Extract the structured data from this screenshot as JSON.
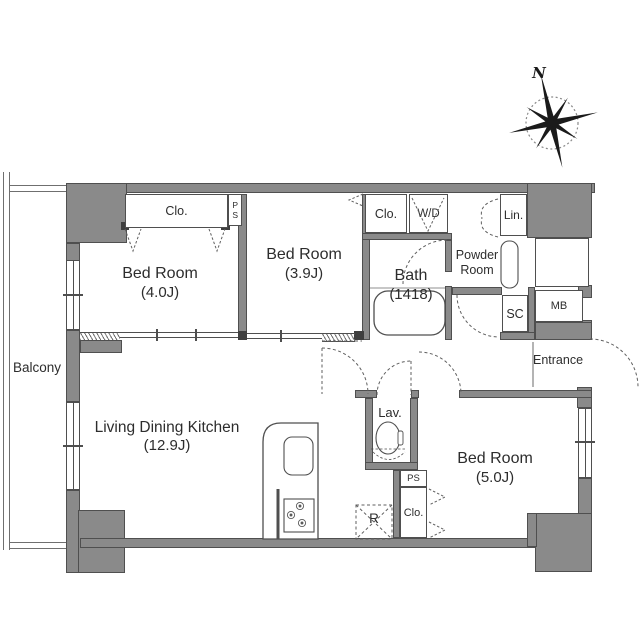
{
  "meta": {
    "plan_type": "apartment floor plan",
    "wall_color": "#8a8a8a",
    "line_color": "#4f4f4f",
    "background_color": "#ffffff"
  },
  "compass": {
    "north": "N"
  },
  "rooms": {
    "balcony": {
      "label": "Balcony"
    },
    "bedroom_nw": {
      "name": "Bed Room",
      "size": "(4.0J)"
    },
    "bedroom_n": {
      "name": "Bed Room",
      "size": "(3.9J)"
    },
    "bath": {
      "name": "Bath",
      "size": "(1418)"
    },
    "powder_room": {
      "line1": "Powder",
      "line2": "Room"
    },
    "ldk": {
      "name": "Living Dining Kitchen",
      "size": "(12.9J)"
    },
    "bedroom_se": {
      "name": "Bed Room",
      "size": "(5.0J)"
    },
    "lavatory": {
      "label": "Lav."
    },
    "entrance": {
      "label": "Entrance"
    }
  },
  "storage": {
    "closet_nw": "Clo.",
    "pipe_space_top": "PS",
    "closet_n": "Clo.",
    "washer_dryer": "W/D",
    "linen": "Lin.",
    "shoe_closet": "SC",
    "meter_box": "MB",
    "pipe_space_bottom": "PS",
    "closet_se": "Clo.",
    "refrigerator": "R"
  }
}
